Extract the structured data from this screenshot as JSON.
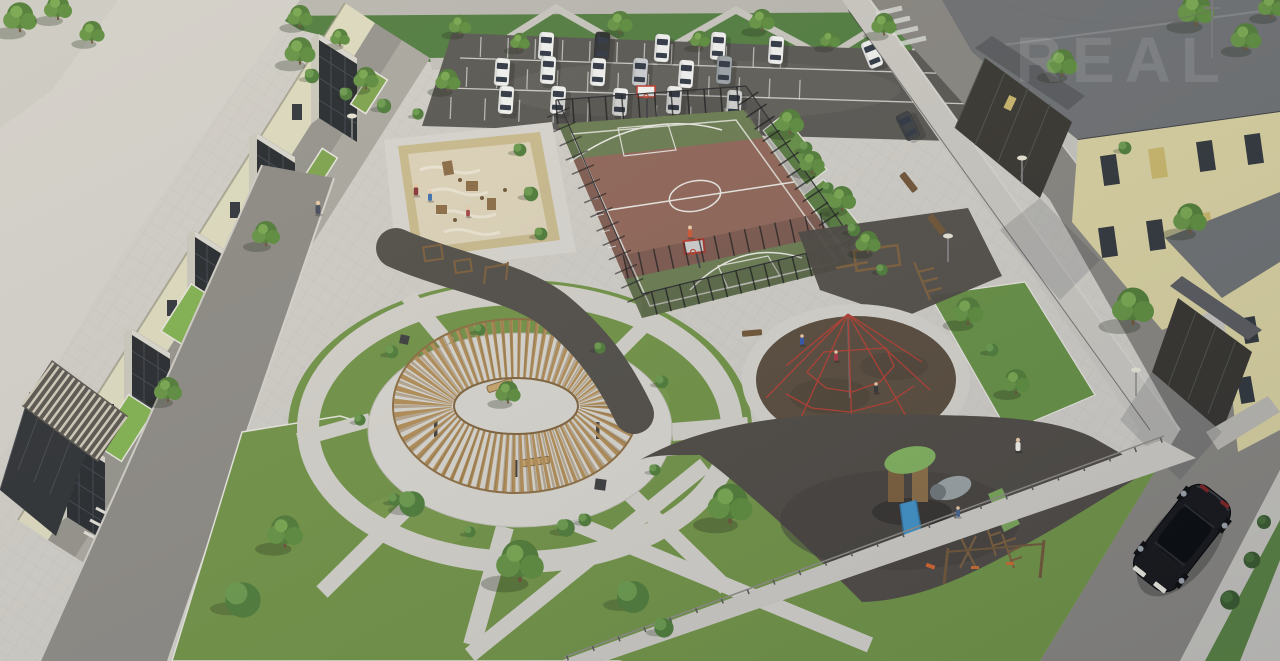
{
  "meta": {
    "type": "3d-aerial-architectural-render",
    "subject": "residential complex courtyard with playgrounds, basketball court and parking",
    "view": "aerial isometric, evening light"
  },
  "watermark": {
    "text": "REAL",
    "color": "#ffffff",
    "opacity": 0.11
  },
  "palette": {
    "paving_light": "#cfccc5",
    "paving_bright": "#d7d4cd",
    "asphalt_road": "#86837d",
    "parking_asphalt": "#56544f",
    "lawn_green": "#6f9143",
    "lawn_bright": "#7fb04c",
    "park_green": "#4e7a3c",
    "court_clay": "#8e6355",
    "court_green": "#68794d",
    "court_line": "#e9e7e1",
    "rubber_dark": "#4c4741",
    "rubber_brown": "#57493a",
    "net_red": "#b23b2e",
    "pergola_wood": "#b28c54",
    "sand": "#ddd2b8",
    "sand_frame": "#c9b98b",
    "roof_left": "#d2cfc8",
    "roof_right": "#6b6d6f",
    "wall_yellow": "#d8cf9e",
    "wall_pale": "#dcd9bd",
    "glass_dark": "#23262a",
    "car_white": "#f1f1ef",
    "car_black": "#141416",
    "slide_blue": "#3f8fc4",
    "canopy_leaf_green": "#7fb05a",
    "play_wood": "#7a5c39"
  },
  "inventory": {
    "apartment_buildings": 4,
    "parked_cars": 20,
    "moving_cars": 1,
    "basketball_court": 1,
    "play_areas": 4,
    "workout_zone": 1,
    "circular_pergola": 1,
    "trees_approx": 30,
    "shrubs_approx": 30,
    "people_approx": 10,
    "benches": 5,
    "street_lamps": 4
  },
  "scene": {
    "buildings": {
      "left": "3-storey block with glazed balcony bays and entrance canopy",
      "right_north": "yellow block with glazed entrance vestibule",
      "right_south": "yellow block with glazed entrance and ramp"
    },
    "parking": {
      "rows": 3,
      "white_cars": 15,
      "dark_or_gray_cars": 5
    },
    "sports": {
      "basketball_court": "clay court, green end zones, white markings, black mesh fence, two hoops",
      "workout_zone": "timber calisthenics frames on dark rubber pad"
    },
    "play": {
      "sandbox": "timber-framed sand play area",
      "pergola": "circular timber ring pergola over paved plaza with benches",
      "climbing_net": "red rope pyramid on round rubber pad",
      "playground": "timber complex with blue slide, tube and swings on dark rubber"
    },
    "traffic": {
      "moving_car": "black sedan on side street"
    }
  }
}
